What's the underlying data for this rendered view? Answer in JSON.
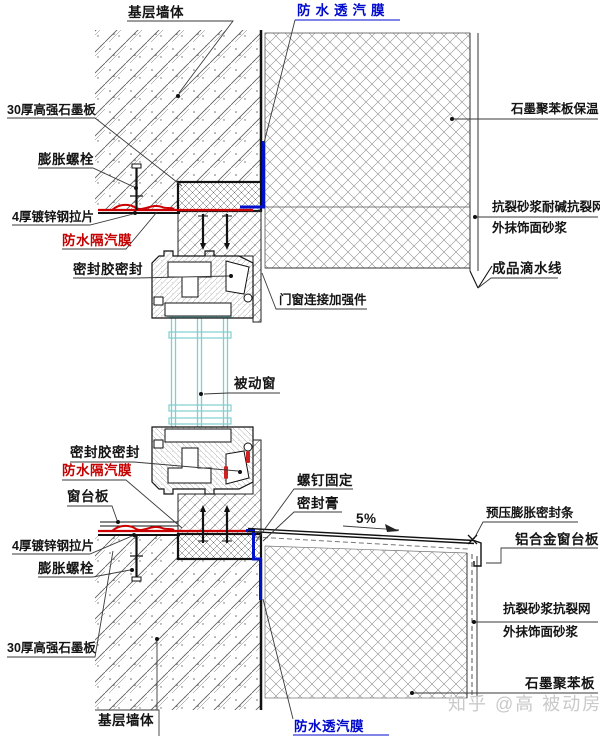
{
  "diagram": {
    "labels": {
      "base_wall_top": "基层墙体",
      "vapor_permeable_top": "防水透汽膜",
      "graphite_board_top": "30厚高强石墨板",
      "expansion_bolt_top": "膨胀螺栓",
      "steel_strap_top": "4厚镀锌钢拉片",
      "vapor_barrier_top": "防水隔汽膜",
      "sealant_seal_top": "密封胶密封",
      "eps_insulation_right": "石墨聚苯板保温",
      "crack_mortar_alkali_mesh": "抗裂砂浆耐碱抗裂网",
      "finish_mortar_top": "外抹饰面砂浆",
      "finished_drip_line": "成品滴水线",
      "window_connector": "门窗连接加强件",
      "passive_window": "被动窗",
      "sealant_seal_bottom": "密封胶密封",
      "vapor_barrier_bottom": "防水隔汽膜",
      "sill_board": "窗台板",
      "steel_strap_bottom": "4厚镀锌钢拉片",
      "expansion_bolt_bottom": "膨胀螺栓",
      "graphite_board_bottom": "30厚高强石墨板",
      "base_wall_bottom": "基层墙体",
      "vapor_permeable_bottom": "防水透汽膜",
      "screw_fixing": "螺钉固定",
      "sealing_paste": "密封膏",
      "slope_percent": "5%",
      "precompressed_seal_strip": "预压膨胀密封条",
      "aluminum_sill_board": "铝合金窗台板",
      "crack_mortar_mesh_bottom": "抗裂砂浆抗裂网",
      "finish_mortar_bottom": "外抹饰面砂浆",
      "eps_board_bottom": "石墨聚苯板"
    },
    "watermark": "知乎 @高 被动房",
    "colors": {
      "membrane_vapor_barrier": "#cc0000",
      "membrane_vapor_permeable": "#0011cc",
      "glazing": "#7fcfcf",
      "line": "#111111",
      "watermark": "#c9c9c9"
    }
  }
}
